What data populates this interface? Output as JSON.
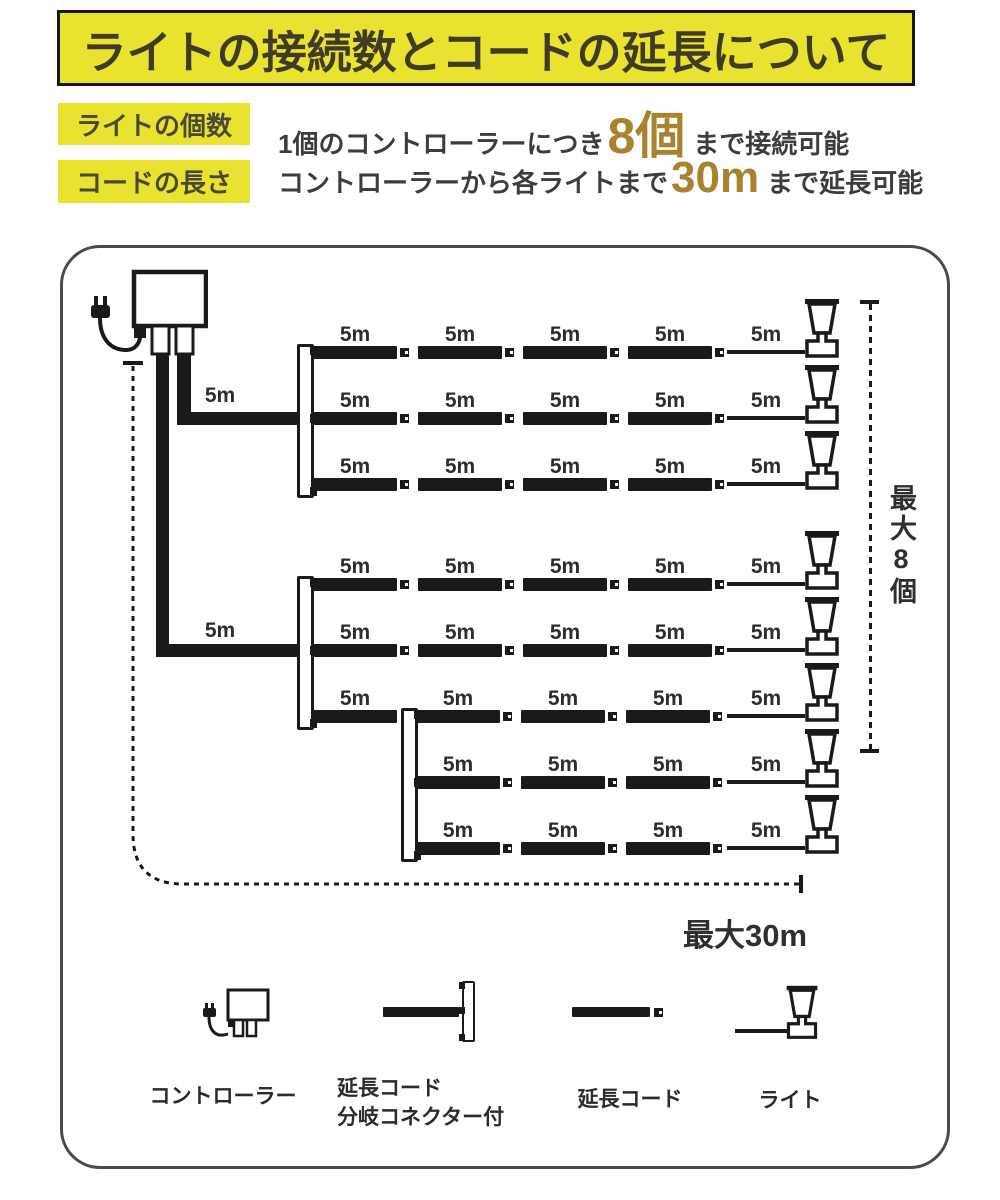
{
  "banner": {
    "title": "ライトの接続数とコードの延長について"
  },
  "specs": [
    {
      "label": "ライトの個数",
      "text_before": "1個のコントローラーにつき",
      "highlight": "8個",
      "text_after": "まで接続可能"
    },
    {
      "label": "コードの長さ",
      "text_before": "コントローラーから各ライトまで",
      "highlight": "30m",
      "text_after": "まで延長可能"
    }
  ],
  "colors": {
    "yellow": "#e9e32f",
    "gold": "#a9822e",
    "ink": "#1a1a1a",
    "frame_gray": "#4a4a4a"
  },
  "diagram": {
    "segment_label": "5m",
    "max_count_label": "最大8個",
    "max_length_label": "最大30m",
    "bar_w": 84,
    "wire": {
      "x": 727,
      "w": 78
    },
    "light_x": 803,
    "feeds": [
      {
        "v": [
          177,
          354,
          14,
          71
        ],
        "h": [
          177,
          412,
          121,
          13
        ],
        "label_pos": [
          198,
          385
        ]
      },
      {
        "v": [
          156,
          354,
          13,
          303
        ],
        "h": [
          156,
          644,
          142,
          13
        ],
        "label_pos": [
          198,
          620
        ]
      }
    ],
    "brackets": [
      {
        "x": 297,
        "y": 344
      },
      {
        "x": 297,
        "y": 576
      },
      {
        "x": 401,
        "y": 708
      }
    ],
    "rows": [
      {
        "y": 352,
        "bars": [
          313,
          418,
          523,
          628
        ],
        "connectors": [
          400,
          505,
          610,
          715
        ],
        "label_centers": [
          355,
          460,
          565,
          670,
          766
        ]
      },
      {
        "y": 418,
        "bars": [
          313,
          418,
          523,
          628
        ],
        "connectors": [
          400,
          505,
          610,
          715
        ],
        "label_centers": [
          355,
          460,
          565,
          670,
          766
        ]
      },
      {
        "y": 484,
        "bars": [
          313,
          418,
          523,
          628
        ],
        "connectors": [
          400,
          505,
          610,
          715
        ],
        "label_centers": [
          355,
          460,
          565,
          670,
          766
        ]
      },
      {
        "y": 584,
        "bars": [
          313,
          418,
          523,
          628
        ],
        "connectors": [
          400,
          505,
          610,
          715
        ],
        "label_centers": [
          355,
          460,
          565,
          670,
          766
        ]
      },
      {
        "y": 650,
        "bars": [
          313,
          418,
          523,
          628
        ],
        "connectors": [
          400,
          505,
          610,
          715
        ],
        "label_centers": [
          355,
          460,
          565,
          670,
          766
        ]
      },
      {
        "y": 716,
        "bars": [
          313,
          416,
          521,
          626
        ],
        "connectors": [
          503,
          608,
          713
        ],
        "label_centers": [
          355,
          458,
          563,
          668,
          766
        ]
      },
      {
        "y": 782,
        "bars": [
          416,
          521,
          626
        ],
        "connectors": [
          503,
          608,
          713
        ],
        "label_centers": [
          458,
          563,
          668,
          766
        ]
      },
      {
        "y": 848,
        "bars": [
          416,
          521,
          626
        ],
        "connectors": [
          503,
          608,
          713
        ],
        "label_centers": [
          458,
          563,
          668,
          766
        ]
      }
    ]
  },
  "legend": {
    "controller": "コントローラー",
    "branch_line1": "延長コード",
    "branch_line2": "分岐コネクター付",
    "cord": "延長コード",
    "light": "ライト"
  }
}
